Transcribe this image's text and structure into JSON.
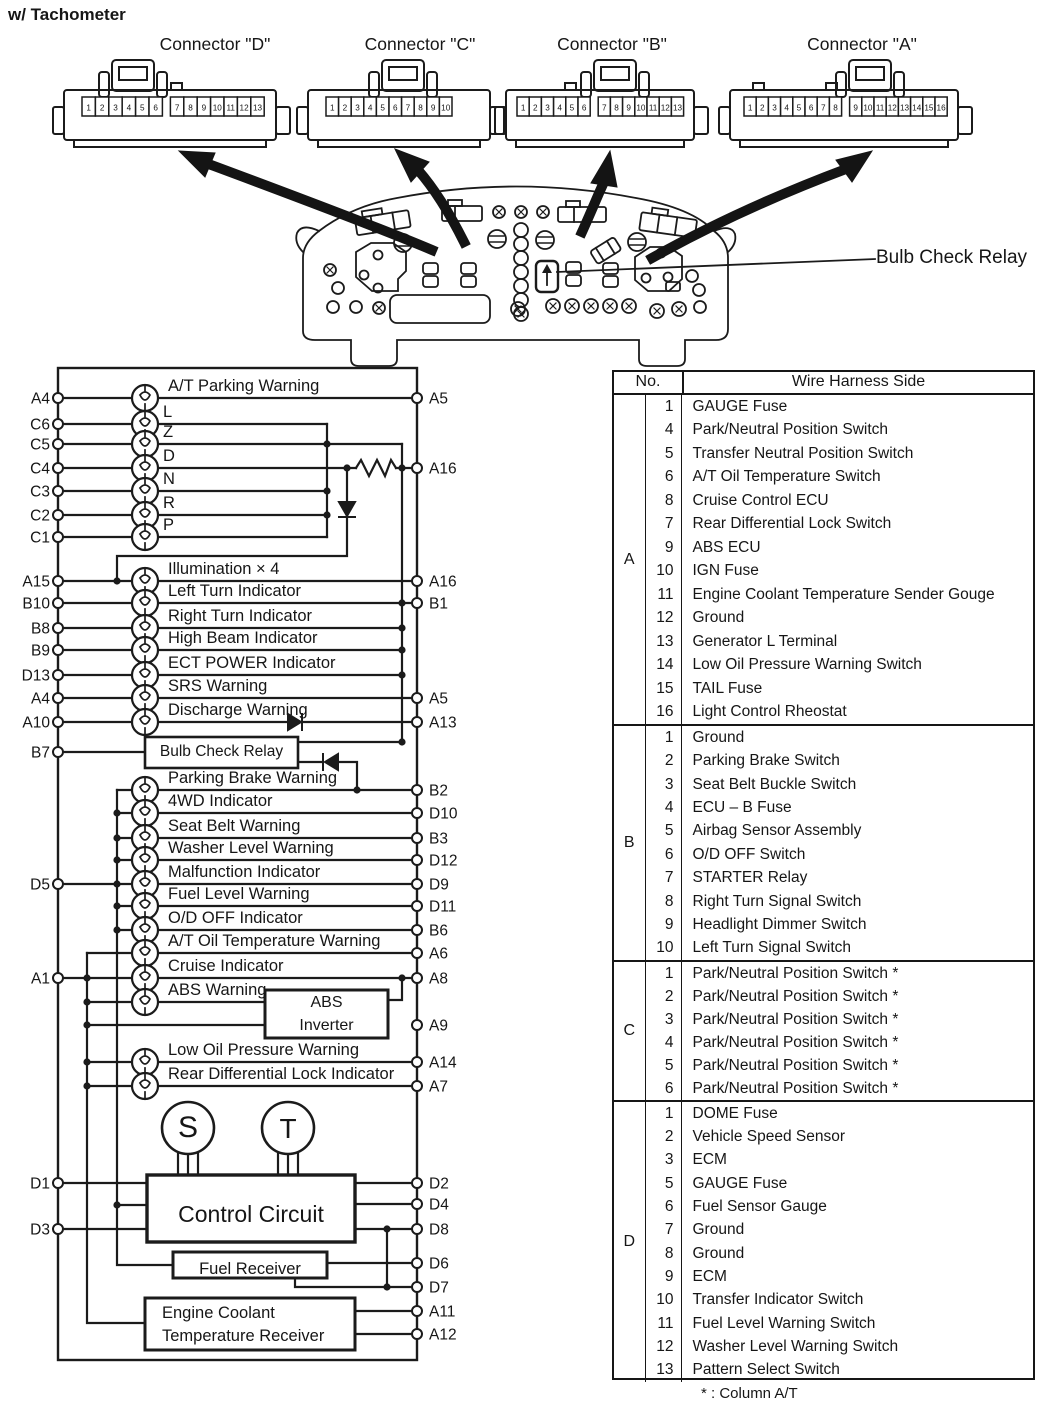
{
  "title": "w/ Tachometer",
  "colors": {
    "ink": "#161616",
    "paper": "#ffffff"
  },
  "connectors": [
    {
      "name": "D",
      "label": "Connector \"D\"",
      "pins": [
        "1",
        "2",
        "3",
        "4",
        "5",
        "6",
        "7",
        "8",
        "9",
        "10",
        "11",
        "12",
        "13"
      ]
    },
    {
      "name": "C",
      "label": "Connector \"C\"",
      "pins": [
        "1",
        "2",
        "3",
        "4",
        "5",
        "6",
        "7",
        "8",
        "9",
        "10"
      ]
    },
    {
      "name": "B",
      "label": "Connector \"B\"",
      "pins": [
        "1",
        "2",
        "3",
        "4",
        "5",
        "6",
        "7",
        "8",
        "9",
        "10",
        "11",
        "12",
        "13"
      ]
    },
    {
      "name": "A",
      "label": "Connector \"A\"",
      "pins": [
        "1",
        "2",
        "3",
        "4",
        "5",
        "6",
        "7",
        "8",
        "9",
        "10",
        "11",
        "12",
        "13",
        "14",
        "15",
        "16"
      ]
    }
  ],
  "cluster_callout": "Bulb Check Relay",
  "circuit": {
    "left_pins": [
      "A4",
      "C6",
      "C5",
      "C4",
      "C3",
      "C2",
      "C1",
      "A15",
      "B10",
      "B8",
      "B9",
      "D13",
      "A4",
      "A10",
      "B7",
      "D5",
      "A1",
      "D1",
      "D3"
    ],
    "right_pins": [
      "A5",
      "A16",
      "A16",
      "B1",
      "A5",
      "A13",
      "B2",
      "D10",
      "B3",
      "D12",
      "D9",
      "D11",
      "B6",
      "A6",
      "A8",
      "A9",
      "A14",
      "A7",
      "D2",
      "D4",
      "D8",
      "D6",
      "D7",
      "A11",
      "A12"
    ],
    "lamp_labels": [
      "A/T Parking Warning",
      "L",
      "Z",
      "D",
      "N",
      "R",
      "P",
      "Illumination × 4",
      "Left Turn Indicator",
      "Right Turn Indicator",
      "High Beam Indicator",
      "ECT POWER Indicator",
      "SRS Warning",
      "Discharge Warning",
      "Parking Brake Warning",
      "4WD Indicator",
      "Seat Belt Warning",
      "Washer Level Warning",
      "Malfunction Indicator",
      "Fuel Level Warning",
      "O/D OFF Indicator",
      "A/T Oil Temperature Warning",
      "Cruise Indicator",
      "ABS Warning",
      "Low Oil Pressure Warning",
      "Rear Differential Lock Indicator"
    ],
    "boxes": {
      "bulb_check_relay": "Bulb Check Relay",
      "abs_inverter_line1": "ABS",
      "abs_inverter_line2": "Inverter",
      "control_circuit": "Control Circuit",
      "fuel_receiver": "Fuel Receiver",
      "ect_receiver_line1": "Engine Coolant",
      "ect_receiver_line2": "Temperature Receiver",
      "speedometer": "S",
      "tachometer": "T"
    }
  },
  "table": {
    "header": {
      "no": "No.",
      "wire": "Wire Harness Side"
    },
    "groups": [
      {
        "letter": "A",
        "rows": [
          {
            "no": "1",
            "label": "GAUGE Fuse"
          },
          {
            "no": "4",
            "label": "Park/Neutral Position Switch"
          },
          {
            "no": "5",
            "label": "Transfer Neutral Position Switch"
          },
          {
            "no": "6",
            "label": "A/T Oil Temperature Switch"
          },
          {
            "no": "8",
            "label": "Cruise Control ECU"
          },
          {
            "no": "7",
            "label": "Rear Differential Lock Switch"
          },
          {
            "no": "9",
            "label": "ABS ECU"
          },
          {
            "no": "10",
            "label": "IGN Fuse"
          },
          {
            "no": "11",
            "label": "Engine Coolant Temperature Sender Gouge"
          },
          {
            "no": "12",
            "label": "Ground"
          },
          {
            "no": "13",
            "label": "Generator L Terminal"
          },
          {
            "no": "14",
            "label": "Low Oil Pressure Warning Switch"
          },
          {
            "no": "15",
            "label": "TAIL Fuse"
          },
          {
            "no": "16",
            "label": "Light Control Rheostat"
          }
        ]
      },
      {
        "letter": "B",
        "rows": [
          {
            "no": "1",
            "label": "Ground"
          },
          {
            "no": "2",
            "label": "Parking Brake Switch"
          },
          {
            "no": "3",
            "label": "Seat Belt Buckle Switch"
          },
          {
            "no": "4",
            "label": "ECU – B Fuse"
          },
          {
            "no": "5",
            "label": "Airbag Sensor Assembly"
          },
          {
            "no": "6",
            "label": "O/D OFF Switch"
          },
          {
            "no": "7",
            "label": "STARTER Relay"
          },
          {
            "no": "8",
            "label": "Right Turn Signal Switch"
          },
          {
            "no": "9",
            "label": "Headlight Dimmer Switch"
          },
          {
            "no": "10",
            "label": "Left Turn Signal Switch"
          }
        ]
      },
      {
        "letter": "C",
        "rows": [
          {
            "no": "1",
            "label": "Park/Neutral Position Switch *"
          },
          {
            "no": "2",
            "label": "Park/Neutral Position Switch *"
          },
          {
            "no": "3",
            "label": "Park/Neutral Position Switch *"
          },
          {
            "no": "4",
            "label": "Park/Neutral Position Switch *"
          },
          {
            "no": "5",
            "label": "Park/Neutral Position Switch *"
          },
          {
            "no": "6",
            "label": "Park/Neutral Position Switch *"
          }
        ]
      },
      {
        "letter": "D",
        "rows": [
          {
            "no": "1",
            "label": "DOME Fuse"
          },
          {
            "no": "2",
            "label": "Vehicle Speed Sensor"
          },
          {
            "no": "3",
            "label": "ECM"
          },
          {
            "no": "5",
            "label": "GAUGE Fuse"
          },
          {
            "no": "6",
            "label": "Fuel Sensor Gauge"
          },
          {
            "no": "7",
            "label": "Ground"
          },
          {
            "no": "8",
            "label": "Ground"
          },
          {
            "no": "9",
            "label": "ECM"
          },
          {
            "no": "10",
            "label": "Transfer Indicator Switch"
          },
          {
            "no": "11",
            "label": "Fuel Level Warning Switch"
          },
          {
            "no": "12",
            "label": "Washer Level Warning Switch"
          },
          {
            "no": "13",
            "label": "Pattern Select Switch"
          }
        ]
      }
    ],
    "footnote": "* : Column A/T"
  }
}
